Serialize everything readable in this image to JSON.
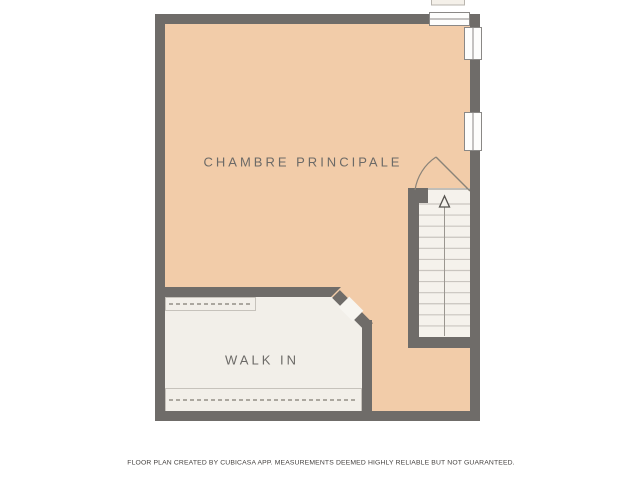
{
  "plan": {
    "type": "floor-plan",
    "rooms": [
      {
        "id": "chambre-principale",
        "label": "CHAMBRE PRINCIPALE",
        "floor_color": "#f2cca9"
      },
      {
        "id": "walk-in",
        "label": "WALK IN",
        "floor_color": "#f2efe9"
      }
    ],
    "stairs": {
      "steps": 12,
      "direction": "up",
      "icon": "arrow-up-icon",
      "floor_color": "#f5f2ec"
    },
    "windows": {
      "count": 3,
      "positions": [
        "top-wall",
        "right-wall-upper",
        "right-wall-lower"
      ]
    },
    "doors": {
      "count": 2,
      "types": [
        "swing-door-at-stairs",
        "open-diagonal-doorway-walk-in"
      ]
    },
    "closet_rails": {
      "count": 2,
      "style": "dashed"
    }
  },
  "footer": {
    "disclaimer": "FLOOR PLAN CREATED BY CUBICASA APP. MEASUREMENTS DEEMED HIGHLY RELIABLE BUT NOT GUARANTEED."
  },
  "colors": {
    "wall": "#6f6c69",
    "bedroom_floor": "#f2cca9",
    "closet_floor": "#f2efe9",
    "stair_floor": "#f5f2ec",
    "window_fill": "#fdfdfc",
    "label_text": "#6c6a67",
    "footer_text": "#454240",
    "background": "#ffffff"
  }
}
